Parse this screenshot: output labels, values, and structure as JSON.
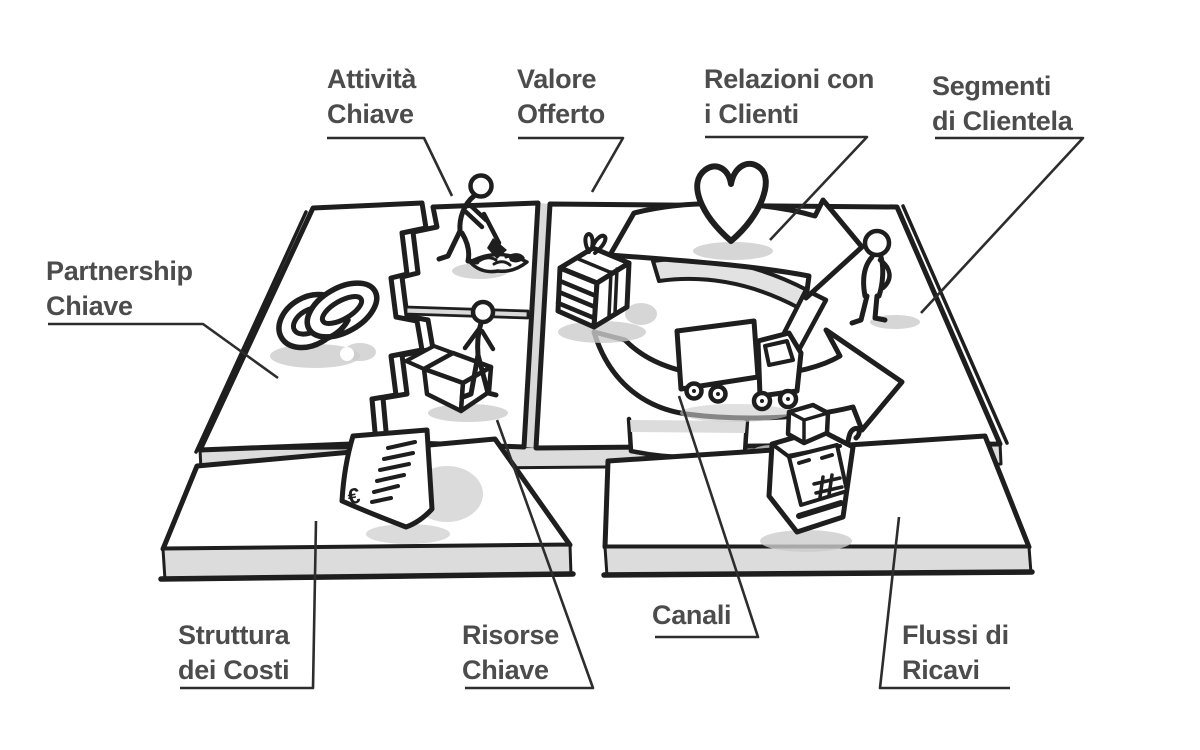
{
  "canvas": {
    "title": "Business Model Canvas (sketch)",
    "language": "Italiano",
    "colors": {
      "ink": "#1e1e1e",
      "label_text": "#4c4c4c",
      "slab_face": "#ffffff",
      "slab_side": "#dcdcdc",
      "shadow": "#cccccc"
    },
    "symbols": {
      "euro": "€"
    },
    "blocks": [
      {
        "id": "partnership",
        "label": "Partnership Chiave",
        "lines": [
          "Partnership",
          "Chiave"
        ],
        "icon": "interlocked-rings"
      },
      {
        "id": "attivita",
        "label": "Attività Chiave",
        "lines": [
          "Attività",
          "Chiave"
        ],
        "icon": "digging-person"
      },
      {
        "id": "valore",
        "label": "Valore Offerto",
        "lines": [
          "Valore",
          "Offerto"
        ],
        "icon": "gift-box"
      },
      {
        "id": "relazioni",
        "label": "Relazioni con i Clienti",
        "lines": [
          "Relazioni con",
          "i Clienti"
        ],
        "icon": "heart"
      },
      {
        "id": "segmenti",
        "label": "Segmenti di Clientela",
        "lines": [
          "Segmenti",
          "di Clientela"
        ],
        "icon": "customer-person"
      },
      {
        "id": "risorse",
        "label": "Risorse Chiave",
        "lines": [
          "Risorse",
          "Chiave"
        ],
        "icon": "person-with-crate"
      },
      {
        "id": "canali",
        "label": "Canali",
        "lines": [
          "Canali"
        ],
        "icon": "delivery-truck"
      },
      {
        "id": "struttura",
        "label": "Struttura dei Costi",
        "lines": [
          "Struttura",
          "dei Costi"
        ],
        "icon": "euro-invoice"
      },
      {
        "id": "flussi",
        "label": "Flussi di Ricavi",
        "lines": [
          "Flussi di",
          "Ricavi"
        ],
        "icon": "cash-register"
      }
    ]
  }
}
